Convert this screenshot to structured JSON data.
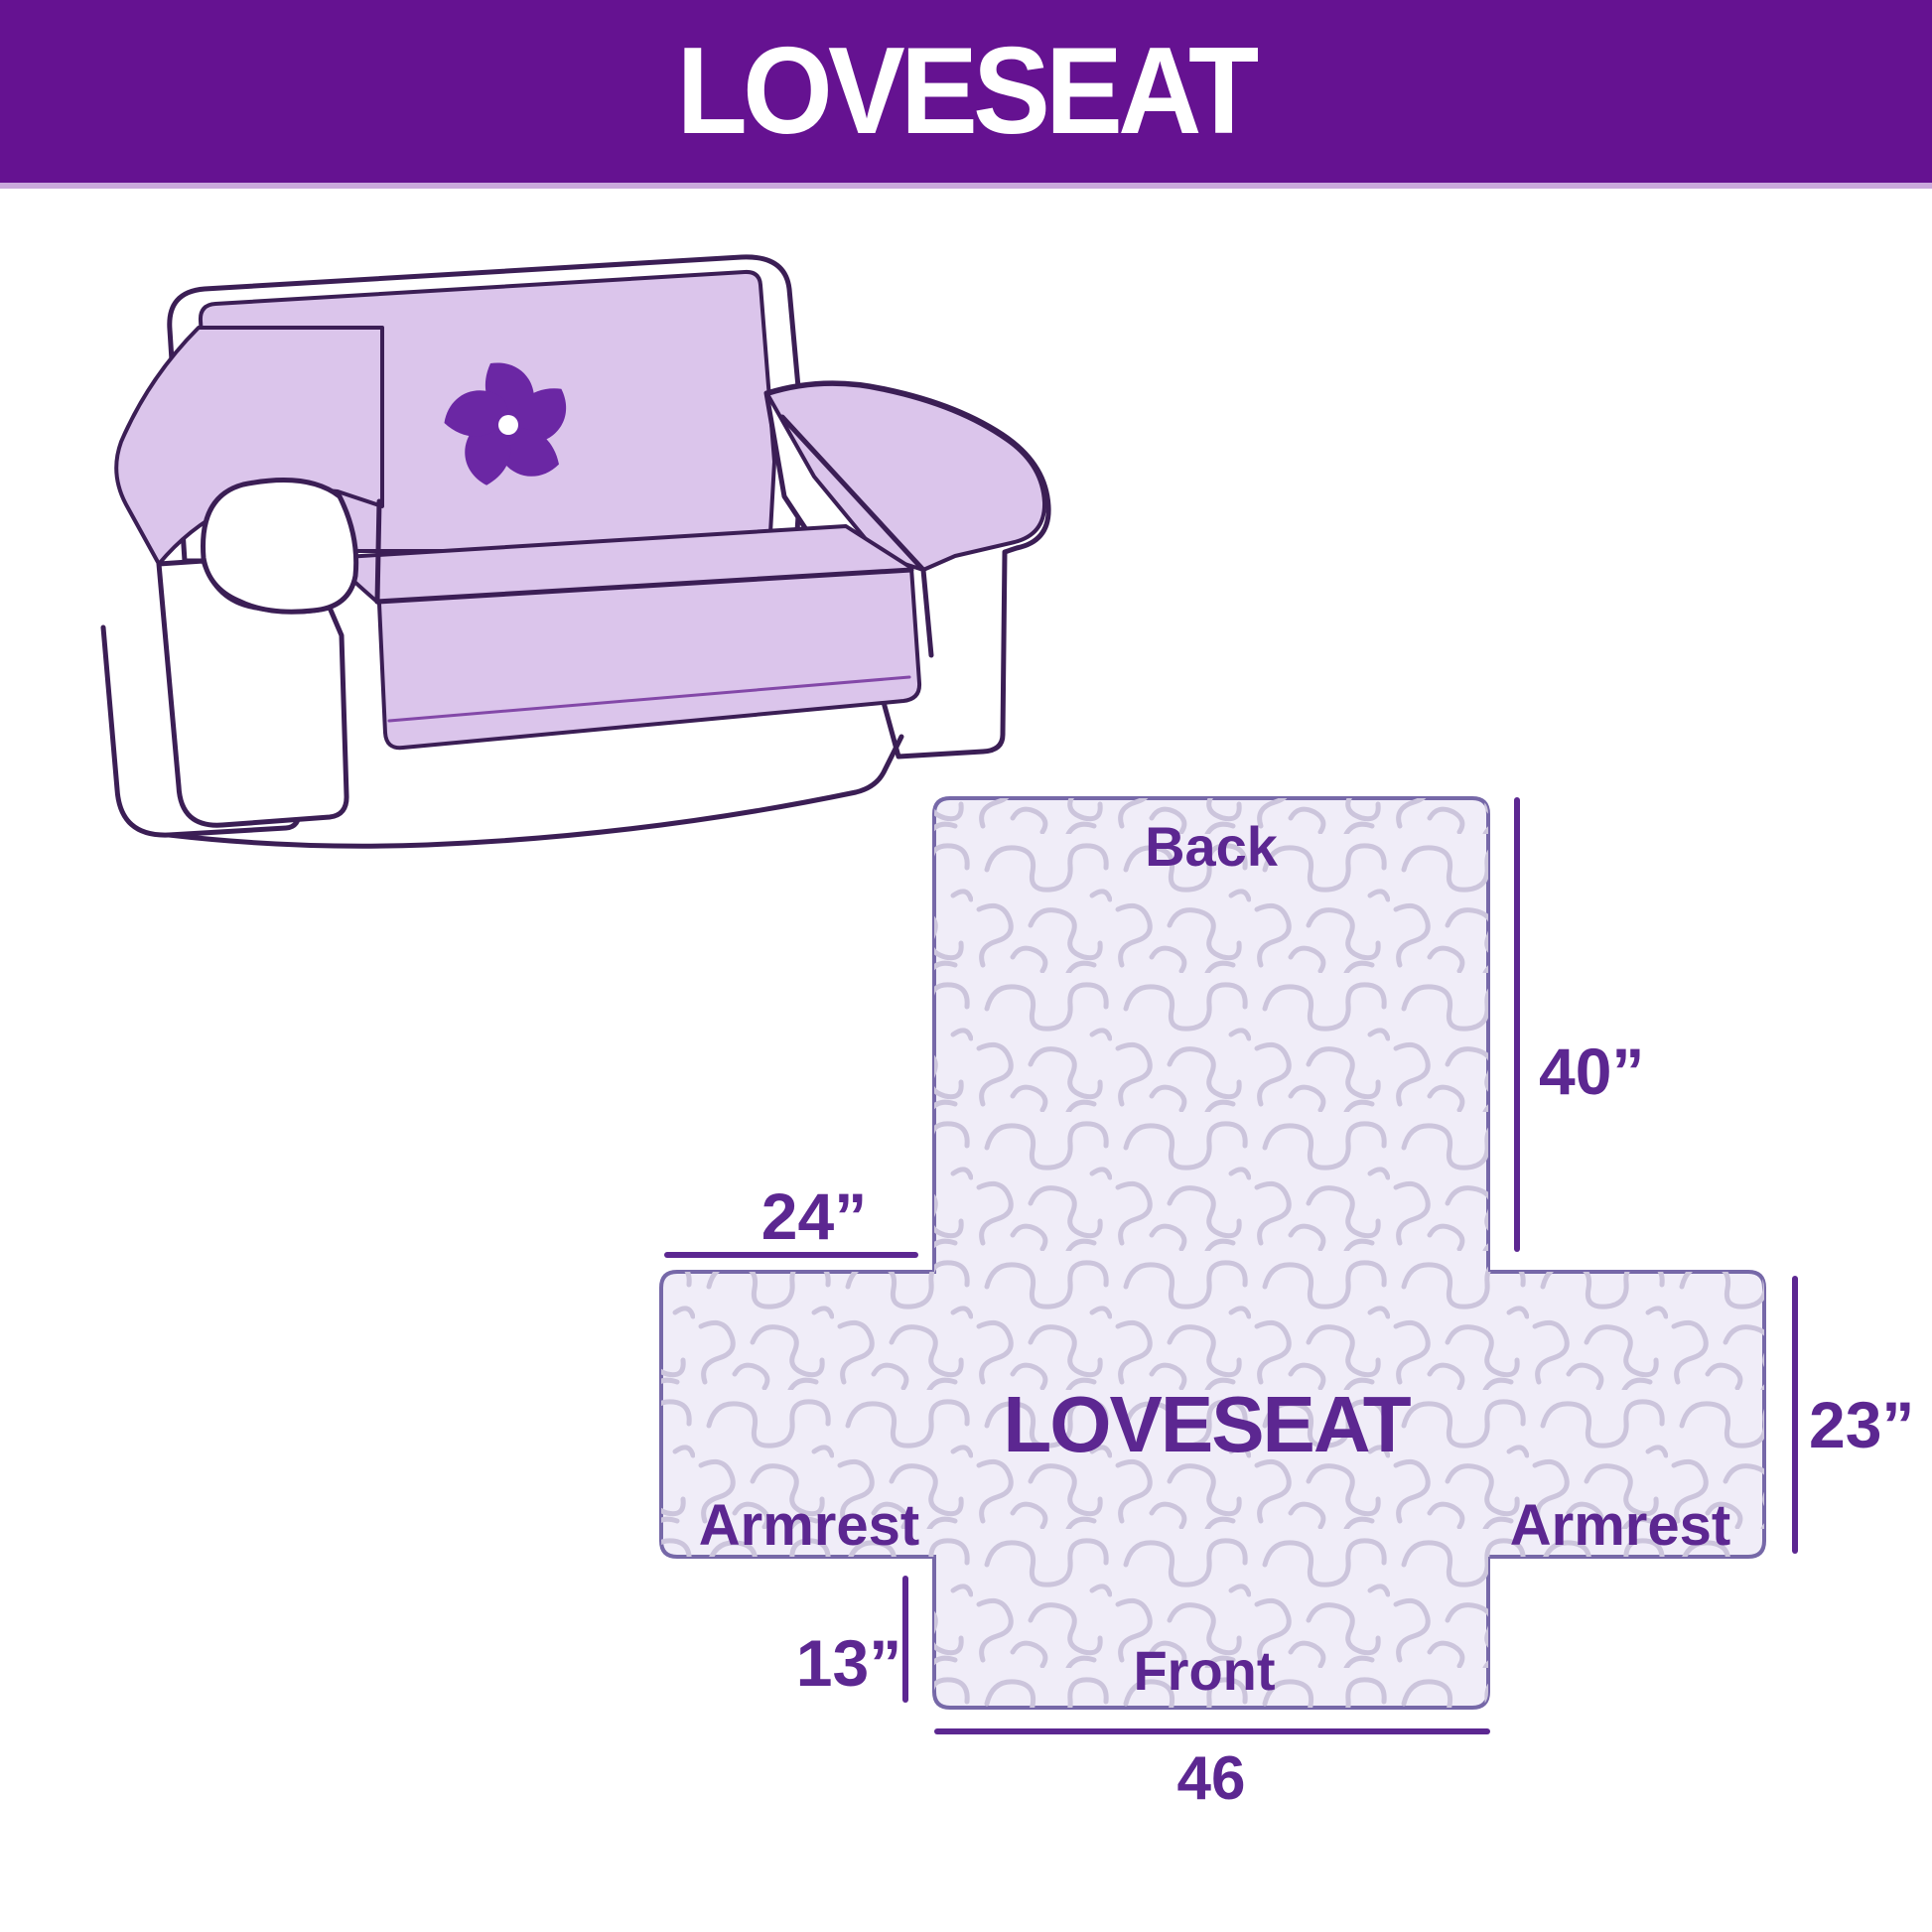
{
  "header": {
    "title": "LOVESEAT",
    "background_color": "#651291",
    "text_color": "#FFFFFF"
  },
  "sofa": {
    "description": "line-art loveseat sofa draped with lavender protective cover",
    "cover_color": "#DBC5EB",
    "outline_color": "#3B1E55",
    "logo_icon": "pinwheel",
    "logo_color": "#6B27A4"
  },
  "diagram": {
    "center_label": "LOVESEAT",
    "section_labels": {
      "back": "Back",
      "front": "Front",
      "armrest_left": "Armrest",
      "armrest_right": "Armrest"
    },
    "dimensions": {
      "back_height": "40”",
      "armrest_width": "24”",
      "armrest_height": "23”",
      "front_height": "13”",
      "front_width": "46"
    },
    "colors": {
      "fill": "#F0EDF8",
      "pattern": "#CCC5DC",
      "outline": "#7668A8",
      "label": "#5C2791"
    }
  }
}
